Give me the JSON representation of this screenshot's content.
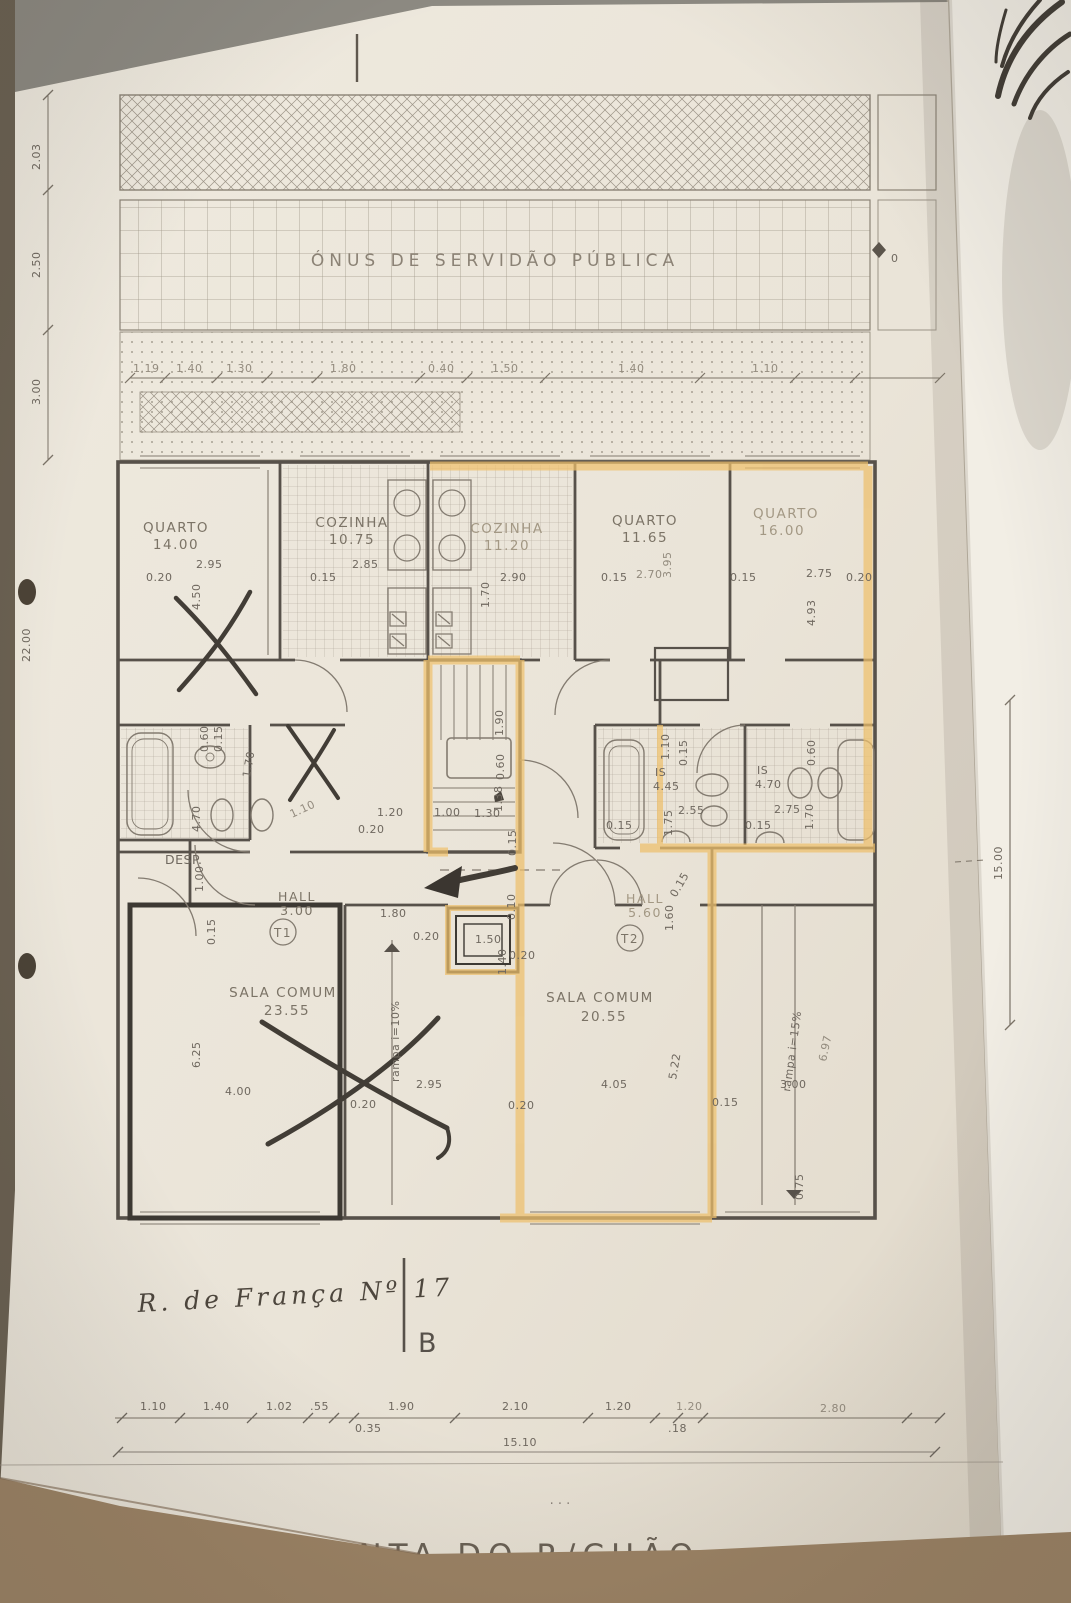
{
  "texts": {
    "servidao": "ÓNUS DE SERVIDÃO PÚBLICA",
    "plan_title": "PLANTA DO R/CHÃO",
    "street_note": "R. de França Nº 17",
    "section_b": "B",
    "zero_mark": "0"
  },
  "rooms": {
    "quarto1": {
      "name": "QUARTO",
      "area": "14.00"
    },
    "cozinha1": {
      "name": "COZINHA",
      "area": "10.75"
    },
    "cozinha2": {
      "name": "COZINHA",
      "area": "11.20"
    },
    "quarto2": {
      "name": "QUARTO",
      "area": "11.65"
    },
    "quarto3": {
      "name": "QUARTO",
      "area": "16.00"
    },
    "desp": {
      "name": "DESP.",
      "area": "1.00"
    },
    "hall1": {
      "name": "HALL",
      "area": "3.00",
      "tag": "T1"
    },
    "hall2": {
      "name": "HALL",
      "area": "5.60",
      "tag": "T2"
    },
    "is1": {
      "name": "IS",
      "area": "4.45"
    },
    "is2": {
      "name": "IS",
      "area": "4.70"
    },
    "sala1": {
      "name": "SALA COMUM",
      "area": "23.55"
    },
    "sala2": {
      "name": "SALA COMUM",
      "area": "20.55"
    },
    "rampa1": "rampa  i=10%",
    "rampa2": "rampa  i=15%"
  },
  "dims": {
    "left": [
      "2.03",
      "2.50",
      "3.00"
    ],
    "left_total": "22.00",
    "right_total": "15.00",
    "right_inner": "6.97",
    "top_row": [
      "1.19",
      "1.40",
      "1.30",
      "1.80",
      "0.40",
      "1.50",
      "1.40",
      "1.10"
    ],
    "upper": [
      "0.20",
      "2.95",
      "4.50",
      "0.15",
      "2.85",
      "1.70",
      "2.90",
      "0.15",
      "3.95",
      "2.70",
      "0.15",
      "2.75",
      "4.93",
      "0.20"
    ],
    "mid": [
      "0.60",
      "0.15",
      "1.70",
      "4.70",
      "1.10",
      "1.90",
      "0.60",
      "1.38",
      "1.20",
      "1.00",
      "1.30",
      "0.20",
      "0.15",
      "1.10",
      "0.15"
    ],
    "baths": [
      "0.60",
      "1.75",
      "2.55",
      "0.15",
      "2.75",
      "1.70",
      "0.15"
    ],
    "halls": [
      "1.00",
      "0.15",
      "0.10",
      "1.80",
      "0.20",
      "1.50",
      "1.40",
      "0.20",
      "1.60",
      "0.15"
    ],
    "lower": [
      "6.25",
      "4.00",
      "0.20",
      "2.95",
      "0.20",
      "4.05",
      "5.22",
      "0.15",
      "3.00",
      "0.75"
    ],
    "bottom_row": [
      "1.10",
      "1.40",
      "1.02",
      ".55",
      "1.90",
      "2.10",
      "1.20",
      "1.20",
      "2.80"
    ],
    "bottom_sub": [
      "0.35",
      ".18"
    ],
    "bottom_total": "15.10"
  }
}
